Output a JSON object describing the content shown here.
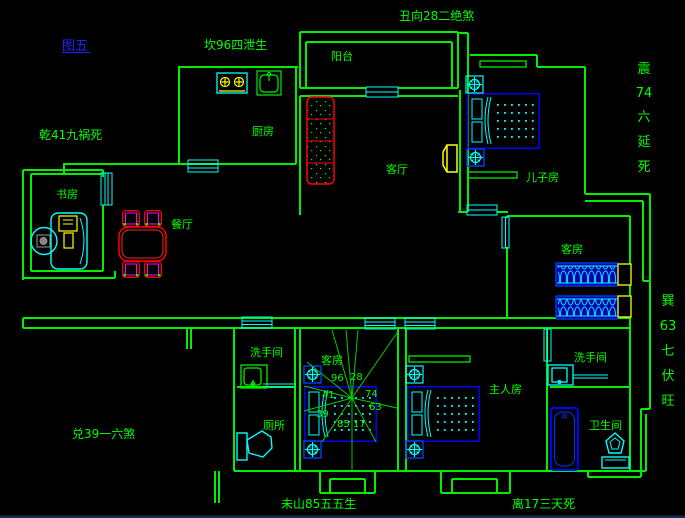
{
  "figure": {
    "label": "图五"
  },
  "fengshui": {
    "top": "丑向28二绝煞",
    "north": "坎96四泄生",
    "northwest": "乾41九祸死",
    "west": "兑39一六煞",
    "south_left": "未山85五五生",
    "south_right": "离17三天死",
    "east": {
      "chars": [
        "震",
        "74",
        "六",
        "延",
        "死"
      ]
    },
    "southeast": {
      "chars": [
        "巽",
        "63",
        "七",
        "伏",
        "旺"
      ]
    }
  },
  "rooms": {
    "balcony": "阳台",
    "kitchen": "厨房",
    "living": "客厅",
    "son": "儿子房",
    "study": "书房",
    "dining": "餐厅",
    "guest_right": "客房",
    "guest_bottom": "客房",
    "master": "主人房",
    "washroom_left": "洗手间",
    "washroom_right": "洗手间",
    "toilet": "厕所",
    "bathroom": "卫生间"
  },
  "compass": {
    "numbers": {
      "n_left": "96",
      "n_right": "28",
      "nw": "41",
      "ne": "74",
      "w": "39",
      "e": "63",
      "s_left": "85",
      "s_right": "17"
    }
  },
  "colors": {
    "background": "#000000",
    "wall_green": "#00ff00",
    "window_cyan": "#00ffff",
    "furniture_blue": "#0000ff",
    "accent_yellow": "#ffff00",
    "accent_red": "#ff0000",
    "accent_magenta": "#ff00ff",
    "figure_blue": "#2222ff"
  }
}
